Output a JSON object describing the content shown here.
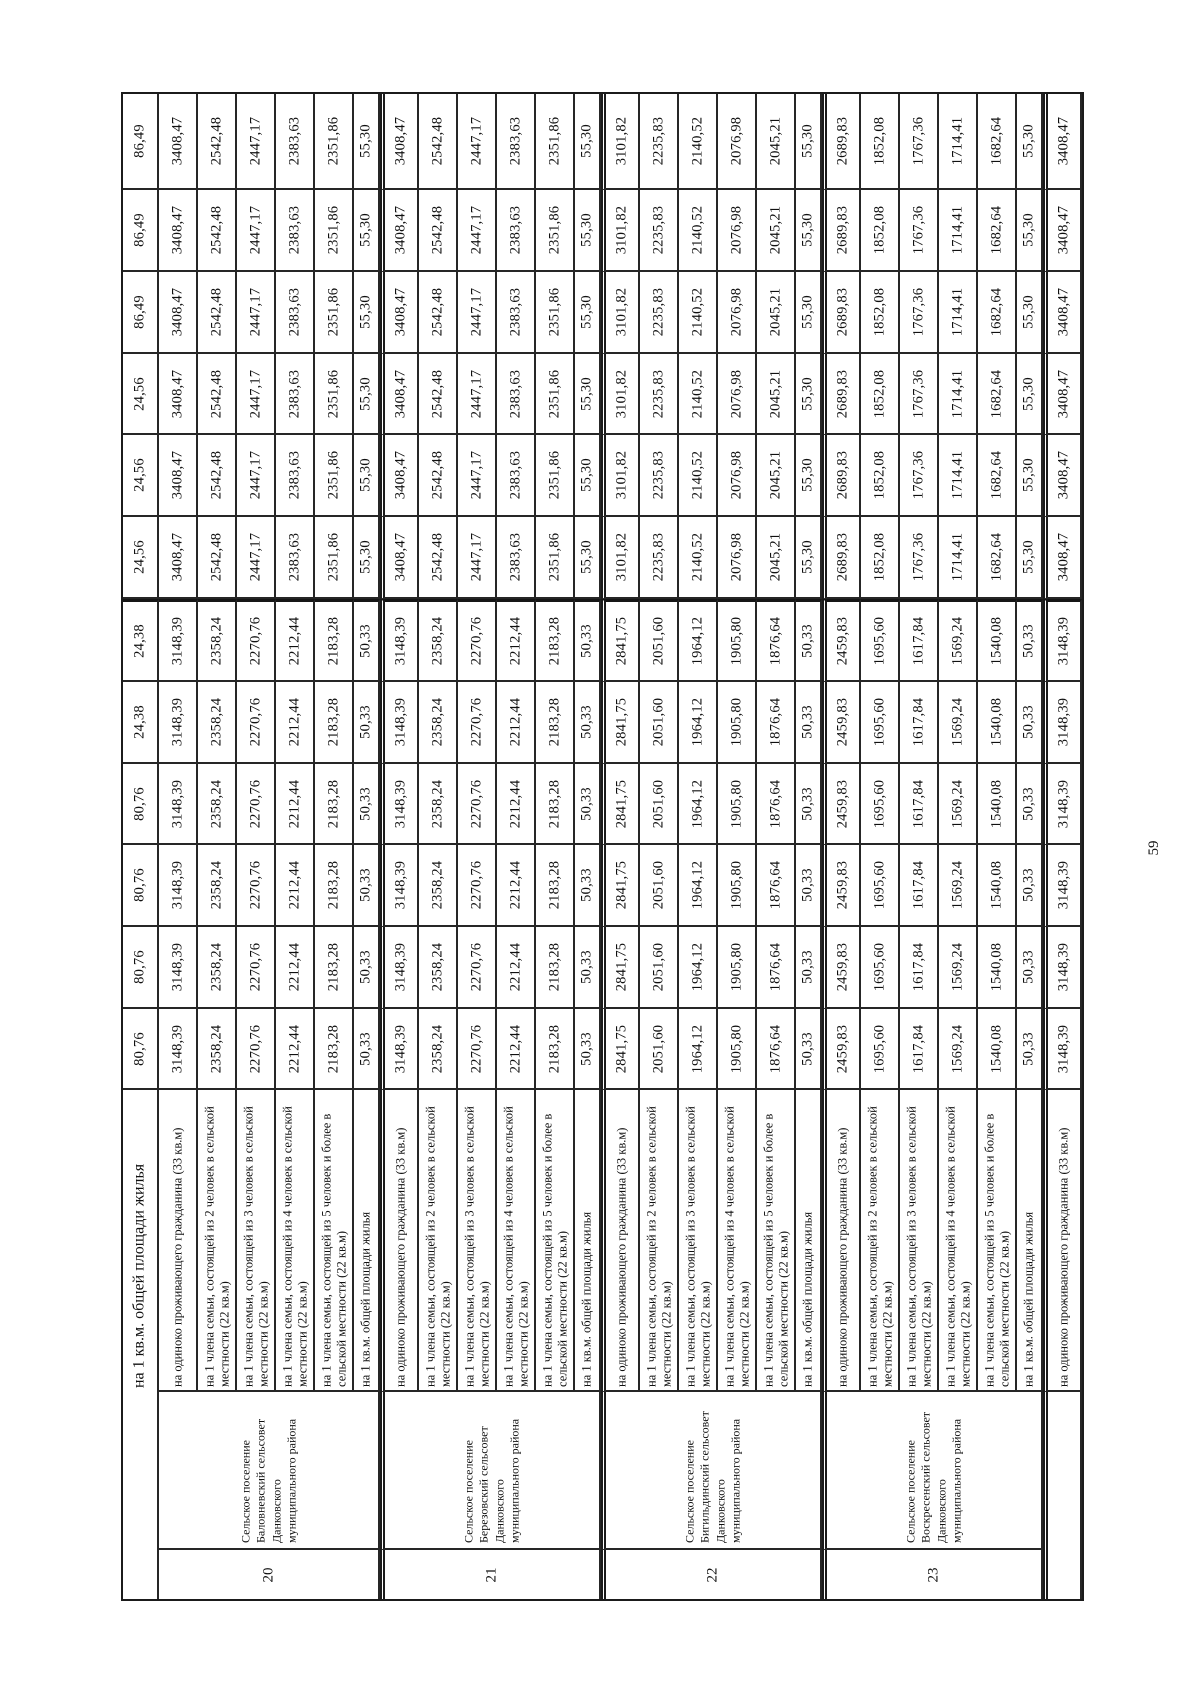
{
  "page": {
    "number": "59"
  },
  "table": {
    "col_groups": [
      {
        "number": "20",
        "name": "Сельское поселение Баловневский сельсовет Данковского муниципального района",
        "rows": [
          {
            "label": "на 1 кв.м. общей площади жилья",
            "span_to_bottom": true,
            "values": [
              "86,49",
              "86,49",
              "86,49",
              "24,56",
              "24,56",
              "24,56",
              "24,38",
              "24,38",
              "80,76",
              "80,76",
              "80,76",
              "80,76"
            ]
          },
          {
            "label": "на одиноко проживающего гражданина (33 кв.м)",
            "values": [
              "3408,47",
              "3408,47",
              "3408,47",
              "3408,47",
              "3408,47",
              "3408,47",
              "3148,39",
              "3148,39",
              "3148,39",
              "3148,39",
              "3148,39",
              "3148,39"
            ]
          },
          {
            "label": "на 1 члена семьи, состоящей из 2 человек в сельской местности (22 кв.м)",
            "values": [
              "2542,48",
              "2542,48",
              "2542,48",
              "2542,48",
              "2542,48",
              "2542,48",
              "2358,24",
              "2358,24",
              "2358,24",
              "2358,24",
              "2358,24",
              "2358,24"
            ]
          },
          {
            "label": "на 1 члена семьи, состоящей из 3 человек в сельской местности (22 кв.м)",
            "values": [
              "2447,17",
              "2447,17",
              "2447,17",
              "2447,17",
              "2447,17",
              "2447,17",
              "2270,76",
              "2270,76",
              "2270,76",
              "2270,76",
              "2270,76",
              "2270,76"
            ]
          },
          {
            "label": "на 1 члена семьи, состоящей из 4 человек в сельской местности (22 кв.м)",
            "values": [
              "2383,63",
              "2383,63",
              "2383,63",
              "2383,63",
              "2383,63",
              "2383,63",
              "2212,44",
              "2212,44",
              "2212,44",
              "2212,44",
              "2212,44",
              "2212,44"
            ]
          },
          {
            "label": "на 1 члена семьи, состоящей из 5 человек и более в сельской местности (22 кв.м)",
            "values": [
              "2351,86",
              "2351,86",
              "2351,86",
              "2351,86",
              "2351,86",
              "2351,86",
              "2183,28",
              "2183,28",
              "2183,28",
              "2183,28",
              "2183,28",
              "2183,28"
            ]
          },
          {
            "label": "на 1 кв.м. общей площади жилья",
            "narrow": true,
            "values": [
              "55,30",
              "55,30",
              "55,30",
              "55,30",
              "55,30",
              "55,30",
              "50,33",
              "50,33",
              "50,33",
              "50,33",
              "50,33",
              "50,33"
            ]
          }
        ]
      },
      {
        "number": "21",
        "name": "Сельское поселение Березовский сельсовет Данковского муниципального района",
        "rows": [
          {
            "label": "на одиноко проживающего гражданина (33 кв.м)",
            "values": [
              "3408,47",
              "3408,47",
              "3408,47",
              "3408,47",
              "3408,47",
              "3408,47",
              "3148,39",
              "3148,39",
              "3148,39",
              "3148,39",
              "3148,39",
              "3148,39"
            ]
          },
          {
            "label": "на 1 члена семьи, состоящей из 2 человек в сельской местности (22 кв.м)",
            "values": [
              "2542,48",
              "2542,48",
              "2542,48",
              "2542,48",
              "2542,48",
              "2542,48",
              "2358,24",
              "2358,24",
              "2358,24",
              "2358,24",
              "2358,24",
              "2358,24"
            ]
          },
          {
            "label": "на 1 члена семьи, состоящей из 3 человек в сельской местности (22 кв.м)",
            "values": [
              "2447,17",
              "2447,17",
              "2447,17",
              "2447,17",
              "2447,17",
              "2447,17",
              "2270,76",
              "2270,76",
              "2270,76",
              "2270,76",
              "2270,76",
              "2270,76"
            ]
          },
          {
            "label": "на 1 члена семьи, состоящей из 4 человек в сельской местности (22 кв.м)",
            "values": [
              "2383,63",
              "2383,63",
              "2383,63",
              "2383,63",
              "2383,63",
              "2383,63",
              "2212,44",
              "2212,44",
              "2212,44",
              "2212,44",
              "2212,44",
              "2212,44"
            ]
          },
          {
            "label": "на 1 члена семьи, состоящей из 5 человек и более в сельской местности (22 кв.м)",
            "values": [
              "2351,86",
              "2351,86",
              "2351,86",
              "2351,86",
              "2351,86",
              "2351,86",
              "2183,28",
              "2183,28",
              "2183,28",
              "2183,28",
              "2183,28",
              "2183,28"
            ]
          },
          {
            "label": "на 1 кв.м. общей площади жилья",
            "narrow": true,
            "values": [
              "55,30",
              "55,30",
              "55,30",
              "55,30",
              "55,30",
              "55,30",
              "50,33",
              "50,33",
              "50,33",
              "50,33",
              "50,33",
              "50,33"
            ]
          }
        ]
      },
      {
        "number": "22",
        "name": "Сельское поселение Бигильдинский сельсовет Данковского муниципального района",
        "rows": [
          {
            "label": "на одиноко проживающего гражданина (33 кв.м)",
            "values": [
              "3101,82",
              "3101,82",
              "3101,82",
              "3101,82",
              "3101,82",
              "3101,82",
              "2841,75",
              "2841,75",
              "2841,75",
              "2841,75",
              "2841,75",
              "2841,75"
            ]
          },
          {
            "label": "на 1 члена семьи, состоящей из 2 человек в сельской местности (22 кв.м)",
            "values": [
              "2235,83",
              "2235,83",
              "2235,83",
              "2235,83",
              "2235,83",
              "2235,83",
              "2051,60",
              "2051,60",
              "2051,60",
              "2051,60",
              "2051,60",
              "2051,60"
            ]
          },
          {
            "label": "на 1 члена семьи, состоящей из 3 человек в сельской местности (22 кв.м)",
            "values": [
              "2140,52",
              "2140,52",
              "2140,52",
              "2140,52",
              "2140,52",
              "2140,52",
              "1964,12",
              "1964,12",
              "1964,12",
              "1964,12",
              "1964,12",
              "1964,12"
            ]
          },
          {
            "label": "на 1 члена семьи, состоящей из 4 человек в сельской местности (22 кв.м)",
            "values": [
              "2076,98",
              "2076,98",
              "2076,98",
              "2076,98",
              "2076,98",
              "2076,98",
              "1905,80",
              "1905,80",
              "1905,80",
              "1905,80",
              "1905,80",
              "1905,80"
            ]
          },
          {
            "label": "на 1 члена семьи, состоящей из 5 человек и более в сельской местности (22 кв.м)",
            "values": [
              "2045,21",
              "2045,21",
              "2045,21",
              "2045,21",
              "2045,21",
              "2045,21",
              "1876,64",
              "1876,64",
              "1876,64",
              "1876,64",
              "1876,64",
              "1876,64"
            ]
          },
          {
            "label": "на 1 кв.м. общей площади жилья",
            "narrow": true,
            "values": [
              "55,30",
              "55,30",
              "55,30",
              "55,30",
              "55,30",
              "55,30",
              "50,33",
              "50,33",
              "50,33",
              "50,33",
              "50,33",
              "50,33"
            ]
          }
        ]
      },
      {
        "number": "23",
        "name": "Сельское поселение Воскресенский сельсовет Данковского муниципального района",
        "rows": [
          {
            "label": "на одиноко проживающего гражданина (33 кв.м)",
            "values": [
              "2689,83",
              "2689,83",
              "2689,83",
              "2689,83",
              "2689,83",
              "2689,83",
              "2459,83",
              "2459,83",
              "2459,83",
              "2459,83",
              "2459,83",
              "2459,83"
            ]
          },
          {
            "label": "на 1 члена семьи, состоящей из 2 человек в сельской местности (22 кв.м)",
            "values": [
              "1852,08",
              "1852,08",
              "1852,08",
              "1852,08",
              "1852,08",
              "1852,08",
              "1695,60",
              "1695,60",
              "1695,60",
              "1695,60",
              "1695,60",
              "1695,60"
            ]
          },
          {
            "label": "на 1 члена семьи, состоящей из 3 человек в сельской местности (22 кв.м)",
            "values": [
              "1767,36",
              "1767,36",
              "1767,36",
              "1767,36",
              "1767,36",
              "1767,36",
              "1617,84",
              "1617,84",
              "1617,84",
              "1617,84",
              "1617,84",
              "1617,84"
            ]
          },
          {
            "label": "на 1 члена семьи, состоящей из 4 человек в сельской местности (22 кв.м)",
            "values": [
              "1714,41",
              "1714,41",
              "1714,41",
              "1714,41",
              "1714,41",
              "1714,41",
              "1569,24",
              "1569,24",
              "1569,24",
              "1569,24",
              "1569,24",
              "1569,24"
            ]
          },
          {
            "label": "на 1 члена семьи, состоящей из 5 человек и более в сельской местности (22 кв.м)",
            "values": [
              "1682,64",
              "1682,64",
              "1682,64",
              "1682,64",
              "1682,64",
              "1682,64",
              "1540,08",
              "1540,08",
              "1540,08",
              "1540,08",
              "1540,08",
              "1540,08"
            ]
          },
          {
            "label": "на 1 кв.м. общей площади жилья",
            "narrow": true,
            "values": [
              "55,30",
              "55,30",
              "55,30",
              "55,30",
              "55,30",
              "55,30",
              "50,33",
              "50,33",
              "50,33",
              "50,33",
              "50,33",
              "50,33"
            ]
          }
        ]
      },
      {
        "number": "",
        "name": "",
        "merged_footer": true,
        "rows": [
          {
            "label": "на одиноко проживающего гражданина (33 кв.м)",
            "values": [
              "3408,47",
              "3408,47",
              "3408,47",
              "3408,47",
              "3408,47",
              "3408,47",
              "3148,39",
              "3148,39",
              "3148,39",
              "3148,39",
              "3148,39",
              "3148,39"
            ]
          }
        ]
      }
    ]
  }
}
